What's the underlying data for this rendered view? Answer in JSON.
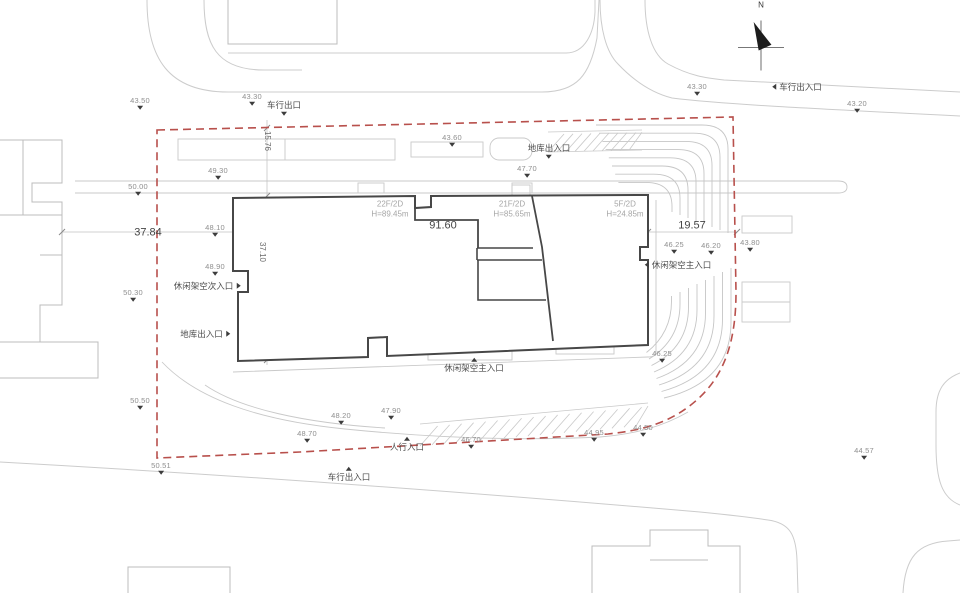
{
  "meta": {
    "drawing_type": "architectural-site-plan"
  },
  "colors": {
    "boundary_red": "#b8504c",
    "building_dark": "#474747",
    "road_gray": "#cccccc",
    "neighbor_gray": "#bcbcbc",
    "spot_label_gray": "#8f8f8f",
    "entrance_text": "#4c4c4c",
    "building_label_gray": "#a6a6a6",
    "marker_black": "#3c3c3c"
  },
  "north": {
    "label": "N"
  },
  "buildings": [
    {
      "floors": "22F/2D",
      "height": "H=89.45m",
      "x": 390,
      "y": 210
    },
    {
      "floors": "21F/2D",
      "height": "H=85.65m",
      "x": 512,
      "y": 210
    },
    {
      "floors": "5F/2D",
      "height": "H=24.85m",
      "x": 625,
      "y": 210
    }
  ],
  "dimensions": [
    {
      "value": "37.84",
      "x": 148,
      "y": 233,
      "rot": 0,
      "large": true
    },
    {
      "value": "91.60",
      "x": 443,
      "y": 226,
      "rot": 0,
      "large": true
    },
    {
      "value": "19.57",
      "x": 692,
      "y": 226,
      "rot": 0,
      "large": true
    },
    {
      "value": "15.76",
      "x": 267,
      "y": 141,
      "rot": 90,
      "large": false
    },
    {
      "value": "37.10",
      "x": 262,
      "y": 252,
      "rot": 90,
      "large": false
    }
  ],
  "spot_elevations": [
    {
      "value": "43.50",
      "x": 140,
      "y": 104
    },
    {
      "value": "43.30",
      "x": 252,
      "y": 100
    },
    {
      "value": "43.60",
      "x": 452,
      "y": 141
    },
    {
      "value": "43.30",
      "x": 697,
      "y": 90
    },
    {
      "value": "43.20",
      "x": 857,
      "y": 107
    },
    {
      "value": "49.30",
      "x": 218,
      "y": 174
    },
    {
      "value": "50.00",
      "x": 138,
      "y": 190
    },
    {
      "value": "47.70",
      "x": 527,
      "y": 172
    },
    {
      "value": "48.10",
      "x": 215,
      "y": 231
    },
    {
      "value": "48.90",
      "x": 215,
      "y": 270
    },
    {
      "value": "50.30",
      "x": 133,
      "y": 296
    },
    {
      "value": "46.25",
      "x": 674,
      "y": 248
    },
    {
      "value": "46.20",
      "x": 711,
      "y": 249
    },
    {
      "value": "43.80",
      "x": 750,
      "y": 246
    },
    {
      "value": "46.25",
      "x": 662,
      "y": 357
    },
    {
      "value": "50.50",
      "x": 140,
      "y": 404
    },
    {
      "value": "48.20",
      "x": 341,
      "y": 419
    },
    {
      "value": "47.90",
      "x": 391,
      "y": 414
    },
    {
      "value": "48.70",
      "x": 307,
      "y": 437
    },
    {
      "value": "46.70",
      "x": 471,
      "y": 443
    },
    {
      "value": "44.95",
      "x": 594,
      "y": 436
    },
    {
      "value": "44.50",
      "x": 643,
      "y": 431
    },
    {
      "value": "50.51",
      "x": 161,
      "y": 469
    },
    {
      "value": "44.57",
      "x": 864,
      "y": 454
    }
  ],
  "entrances": [
    {
      "label": "车行出口",
      "x": 284,
      "y": 108,
      "dir": "down"
    },
    {
      "label": "地库出入口",
      "x": 549,
      "y": 151,
      "dir": "down"
    },
    {
      "label": "车行出入口",
      "x": 797,
      "y": 87,
      "dir": "left"
    },
    {
      "label": "休闲架空次入口",
      "x": 207,
      "y": 286,
      "dir": "right"
    },
    {
      "label": "地库出入口",
      "x": 205,
      "y": 334,
      "dir": "right"
    },
    {
      "label": "休闲架空主入口",
      "x": 678,
      "y": 265,
      "dir": "left"
    },
    {
      "label": "休闲架空主入口",
      "x": 474,
      "y": 365,
      "dir": "up"
    },
    {
      "label": "人行入口",
      "x": 407,
      "y": 444,
      "dir": "up"
    },
    {
      "label": "车行出入口",
      "x": 349,
      "y": 474,
      "dir": "up"
    }
  ]
}
